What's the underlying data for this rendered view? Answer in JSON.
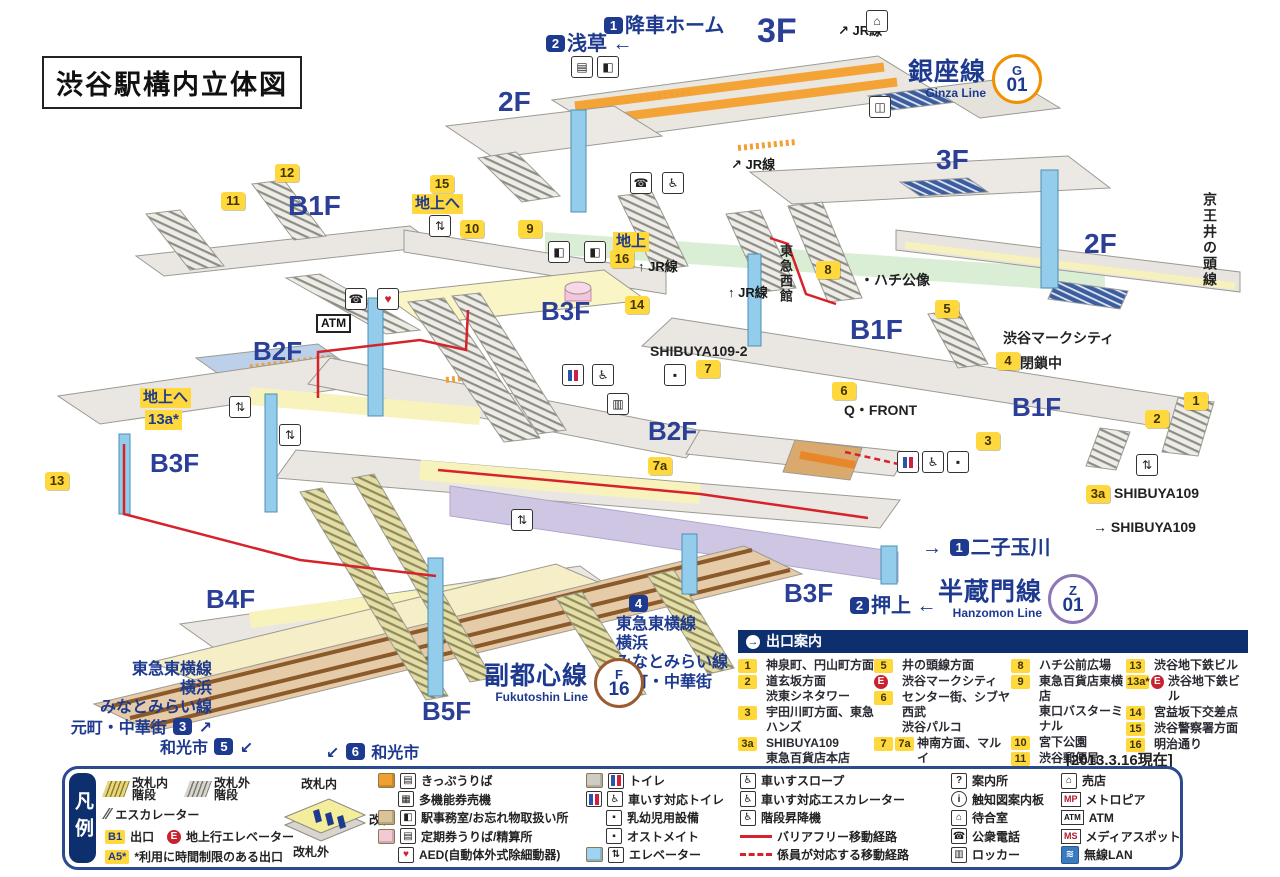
{
  "title": "渋谷駅構内立体図",
  "date_note": "[2013.3.16現在]",
  "colors": {
    "navy": "#1e3a8f",
    "panel_navy": "#0e2f6e",
    "exit_yellow": "#ffd83d",
    "route_red": "#d6232b",
    "ginza_orange": "#f19000",
    "hanzomon_purple": "#8f76b4",
    "fukutoshin_brown": "#9c5b2e",
    "pillar_blue": "#93cdeb"
  },
  "line_badges": [
    {
      "name_jp": "銀座線",
      "name_en": "Ginza Line",
      "code_letter": "G",
      "code_number": "01",
      "color": "#f19000"
    },
    {
      "name_jp": "半蔵門線",
      "name_en": "Hanzomon Line",
      "code_letter": "Z",
      "code_number": "01",
      "color": "#8f76b4"
    },
    {
      "name_jp": "副都心線",
      "name_en": "Fukutoshin Line",
      "code_letter": "F",
      "code_number": "16",
      "color": "#9c5b2e"
    }
  ],
  "map": {
    "floors": [
      [
        "3F",
        757,
        12,
        34
      ],
      [
        "2F",
        498,
        86,
        28
      ],
      [
        "3F",
        936,
        144,
        28
      ],
      [
        "2F",
        1084,
        228,
        28
      ],
      [
        "B1F",
        288,
        190,
        28
      ],
      [
        "B1F",
        850,
        314,
        28
      ],
      [
        "B1F",
        1012,
        392,
        26
      ],
      [
        "B2F",
        253,
        336,
        26
      ],
      [
        "B2F",
        648,
        416,
        26
      ],
      [
        "B3F",
        541,
        296,
        26
      ],
      [
        "B3F",
        150,
        448,
        26
      ],
      [
        "B3F",
        784,
        578,
        26
      ],
      [
        "B4F",
        206,
        584,
        26
      ],
      [
        "B5F",
        422,
        696,
        26
      ]
    ],
    "exit_badges": [
      [
        "1",
        1184,
        392
      ],
      [
        "2",
        1145,
        410
      ],
      [
        "3",
        976,
        432
      ],
      [
        "4",
        996,
        352
      ],
      [
        "5",
        935,
        300
      ],
      [
        "6",
        832,
        382
      ],
      [
        "7",
        696,
        360
      ],
      [
        "7a",
        648,
        457
      ],
      [
        "8",
        816,
        261
      ],
      [
        "9",
        518,
        220
      ],
      [
        "10",
        460,
        220
      ],
      [
        "11",
        221,
        192
      ],
      [
        "12",
        275,
        164
      ],
      [
        "13",
        45,
        472
      ],
      [
        "14",
        625,
        296
      ],
      [
        "15",
        430,
        175
      ],
      [
        "16",
        610,
        250
      ],
      [
        "3a",
        1086,
        485
      ]
    ],
    "tags": [
      [
        "地上へ",
        412,
        194
      ],
      [
        "地上",
        613,
        232
      ],
      [
        "地上へ",
        140,
        388
      ],
      [
        "13a*",
        145,
        410
      ]
    ],
    "nav": [
      [
        "[1]降車ホーム",
        602,
        14,
        20,
        "left"
      ],
      [
        "[2]浅草 ←",
        544,
        32,
        20,
        "left"
      ],
      [
        "→ [1]二子玉川",
        922,
        536,
        20,
        "left"
      ],
      [
        "[2]押上 ←",
        848,
        594,
        20,
        "left"
      ],
      [
        "[4]",
        627,
        595,
        16,
        "left"
      ],
      [
        "東急東横線\n横浜\nみなとみらい線\n元町・中華街",
        616,
        615,
        16,
        "left"
      ],
      [
        "東急東横線\n横浜\nみなとみらい線\n元町・中華街 [3] ↗",
        52,
        660,
        16,
        "right"
      ],
      [
        "和光市 [5] ↙",
        160,
        738,
        16,
        "left"
      ],
      [
        "↙ [6] 和光市",
        326,
        743,
        16,
        "left"
      ]
    ],
    "jr_labels": [
      [
        "↗ JR線",
        838,
        20
      ],
      [
        "↗ JR線",
        731,
        154
      ],
      [
        "↑ JR線",
        638,
        256
      ],
      [
        "↑ JR線",
        728,
        282
      ]
    ],
    "places": [
      [
        "・ハチ公像",
        860,
        270
      ],
      [
        "渋谷マークシティ",
        1003,
        328
      ],
      [
        "閉鎖中",
        1020,
        353
      ],
      [
        "SHIBUYA109-2",
        650,
        343
      ],
      [
        "Q・FRONT",
        844,
        400
      ],
      [
        "SHIBUYA109",
        1114,
        485
      ],
      [
        "→ SHIBUYA109",
        1093,
        519
      ]
    ],
    "vertical": [
      [
        "東急西館",
        776,
        244,
        13
      ],
      [
        "京王井の頭線",
        1200,
        192,
        14
      ]
    ],
    "atm_label": "ATM",
    "icons": [
      [
        "ticket",
        571,
        56
      ],
      [
        "office",
        597,
        56
      ],
      [
        "shop",
        866,
        10
      ],
      [
        "bus",
        869,
        96
      ],
      [
        "phone",
        630,
        172
      ],
      [
        "wheelchair",
        662,
        172
      ],
      [
        "office",
        548,
        241
      ],
      [
        "office",
        584,
        241
      ],
      [
        "elevator",
        429,
        215
      ],
      [
        "phone",
        345,
        288
      ],
      [
        "aed",
        377,
        288
      ],
      [
        "toilet",
        562,
        364
      ],
      [
        "wheelchair",
        592,
        364
      ],
      [
        "baby",
        664,
        364
      ],
      [
        "elevator",
        229,
        396
      ],
      [
        "elevator",
        279,
        424
      ],
      [
        "toilet",
        897,
        451
      ],
      [
        "wheelchair",
        922,
        451
      ],
      [
        "baby",
        947,
        451
      ],
      [
        "elevator",
        1136,
        454
      ],
      [
        "elevator",
        511,
        509
      ],
      [
        "locker",
        607,
        393
      ]
    ]
  },
  "exit_guide": {
    "header": "出口案内",
    "columns": [
      [
        {
          "b": [
            [
              "1",
              "y"
            ]
          ],
          "l": [
            "神泉町、円山町方面"
          ]
        },
        {
          "b": [
            [
              "2",
              "y"
            ]
          ],
          "l": [
            "道玄坂方面",
            "渋東シネタワー"
          ]
        },
        {
          "b": [
            [
              "3",
              "y"
            ]
          ],
          "l": [
            "宇田川町方面、東急ハンズ"
          ]
        },
        {
          "b": [
            [
              "3a",
              "y"
            ]
          ],
          "l": [
            "SHIBUYA109",
            "東急百貨店本店"
          ]
        },
        {
          "b": [
            [
              "4",
              "y"
            ]
          ],
          "l": [
            "閉鎖中"
          ]
        }
      ],
      [
        {
          "b": [
            [
              "5",
              "y"
            ]
          ],
          "l": [
            "井の頭線方面"
          ]
        },
        {
          "b": [
            [
              "E",
              "r"
            ]
          ],
          "l": [
            "渋谷マークシティ"
          ]
        },
        {
          "b": [
            [
              "6",
              "y"
            ]
          ],
          "l": [
            "センター街、シブヤ西武",
            "渋谷パルコ"
          ]
        },
        {
          "b": [
            [
              "7",
              "y"
            ],
            [
              "7a",
              "y"
            ]
          ],
          "l": [
            "神南方面、マルイ",
            "SHIBUYA109-2"
          ]
        }
      ],
      [
        {
          "b": [
            [
              "8",
              "y"
            ]
          ],
          "l": [
            "ハチ公前広場"
          ]
        },
        {
          "b": [
            [
              "9",
              "y"
            ]
          ],
          "l": [
            "東急百貨店東横店",
            "東口バスターミナル"
          ]
        },
        {
          "b": [
            [
              "10",
              "y"
            ]
          ],
          "l": [
            "宮下公園"
          ]
        },
        {
          "b": [
            [
              "11",
              "y"
            ]
          ],
          "l": [
            "渋谷郵便局"
          ]
        },
        {
          "b": [
            [
              "12",
              "y"
            ]
          ],
          "l": [
            "宮益坂下交差点"
          ]
        }
      ],
      [
        {
          "b": [
            [
              "13",
              "y"
            ]
          ],
          "l": [
            "渋谷地下鉄ビル"
          ]
        },
        {
          "b": [
            [
              "13a*",
              "y"
            ],
            [
              "E",
              "r"
            ]
          ],
          "l": [
            "渋谷地下鉄ビル"
          ]
        },
        {
          "b": [
            [
              "14",
              "y"
            ]
          ],
          "l": [
            "宮益坂下交差点"
          ]
        },
        {
          "b": [
            [
              "15",
              "y"
            ]
          ],
          "l": [
            "渋谷警察署方面"
          ]
        },
        {
          "b": [
            [
              "16",
              "y"
            ]
          ],
          "l": [
            "明治通り"
          ]
        }
      ]
    ]
  },
  "legend": {
    "tab": "凡例",
    "gate": {
      "inside": "改札内",
      "gate": "改札",
      "outside": "改札外"
    },
    "g1": [
      {
        "ic": [
          "stairs-y"
        ],
        "t": "改札内\n階段",
        "x": 0,
        "y": 4
      },
      {
        "ic": [
          "stairs-g"
        ],
        "t": "改札外\n階段",
        "x": 82,
        "y": 4
      },
      {
        "ic": [
          "esc"
        ],
        "t": "エスカレーター",
        "x": 0,
        "y": 36
      },
      {
        "ic": [
          "chip:B1"
        ],
        "t": "出口",
        "x": 0,
        "y": 57
      },
      {
        "ic": [
          "chipr:E"
        ],
        "t": "地上行エレベーター",
        "x": 62,
        "y": 57
      },
      {
        "ic": [
          "chip:A5*"
        ],
        "t": "*利用に時間制限のある出口",
        "x": 0,
        "y": 77
      }
    ],
    "g3": [
      {
        "ic": [
          "cube-o",
          "box:▤"
        ],
        "t": "きっぷうりば"
      },
      {
        "ic": [
          "sp",
          "box:▦"
        ],
        "t": "多機能券売機"
      },
      {
        "ic": [
          "cube-t",
          "box:◧"
        ],
        "t": "駅事務室/お忘れ物取扱い所"
      },
      {
        "ic": [
          "cube-p",
          "box:▤"
        ],
        "t": "定期券うりば/精算所"
      },
      {
        "ic": [
          "sp",
          "boxa"
        ],
        "t": "AED(自動体外式除細動器)"
      }
    ],
    "g4": [
      {
        "ic": [
          "cube-g",
          "boxt"
        ],
        "t": "トイレ"
      },
      {
        "ic": [
          "boxt",
          "box:♿"
        ],
        "t": "車いす対応トイレ"
      },
      {
        "ic": [
          "sp",
          "box:▪"
        ],
        "t": "乳幼児用設備"
      },
      {
        "ic": [
          "sp",
          "box:▪"
        ],
        "t": "オストメイト"
      },
      {
        "ic": [
          "cube-b",
          "box:⇅"
        ],
        "t": "エレベーター"
      }
    ],
    "g5": [
      {
        "ic": [
          "box:♿"
        ],
        "t": "車いすスロープ"
      },
      {
        "ic": [
          "box:♿"
        ],
        "t": "車いす対応エスカレーター"
      },
      {
        "ic": [
          "box:♿"
        ],
        "t": "階段昇降機"
      },
      {
        "ic": [
          "sw"
        ],
        "t": "バリアフリー移動経路"
      },
      {
        "ic": [
          "swd"
        ],
        "t": "係員が対応する移動経路"
      }
    ],
    "g6": [
      {
        "ic": [
          "box:?"
        ],
        "t": "案内所"
      },
      {
        "ic": [
          "boxc:i"
        ],
        "t": "触知図案内板"
      },
      {
        "ic": [
          "box:⌂"
        ],
        "t": "待合室"
      },
      {
        "ic": [
          "box:☎"
        ],
        "t": "公衆電話"
      },
      {
        "ic": [
          "box:▥"
        ],
        "t": "ロッカー"
      }
    ],
    "g7": [
      {
        "ic": [
          "box:⌂"
        ],
        "t": "売店"
      },
      {
        "ic": [
          "chipsq:MP"
        ],
        "t": "メトロピア"
      },
      {
        "ic": [
          "chipd:ATM"
        ],
        "t": "ATM"
      },
      {
        "ic": [
          "chipsq:MS"
        ],
        "t": "メディアスポット"
      },
      {
        "ic": [
          "wlan"
        ],
        "t": "無線LAN"
      }
    ]
  }
}
